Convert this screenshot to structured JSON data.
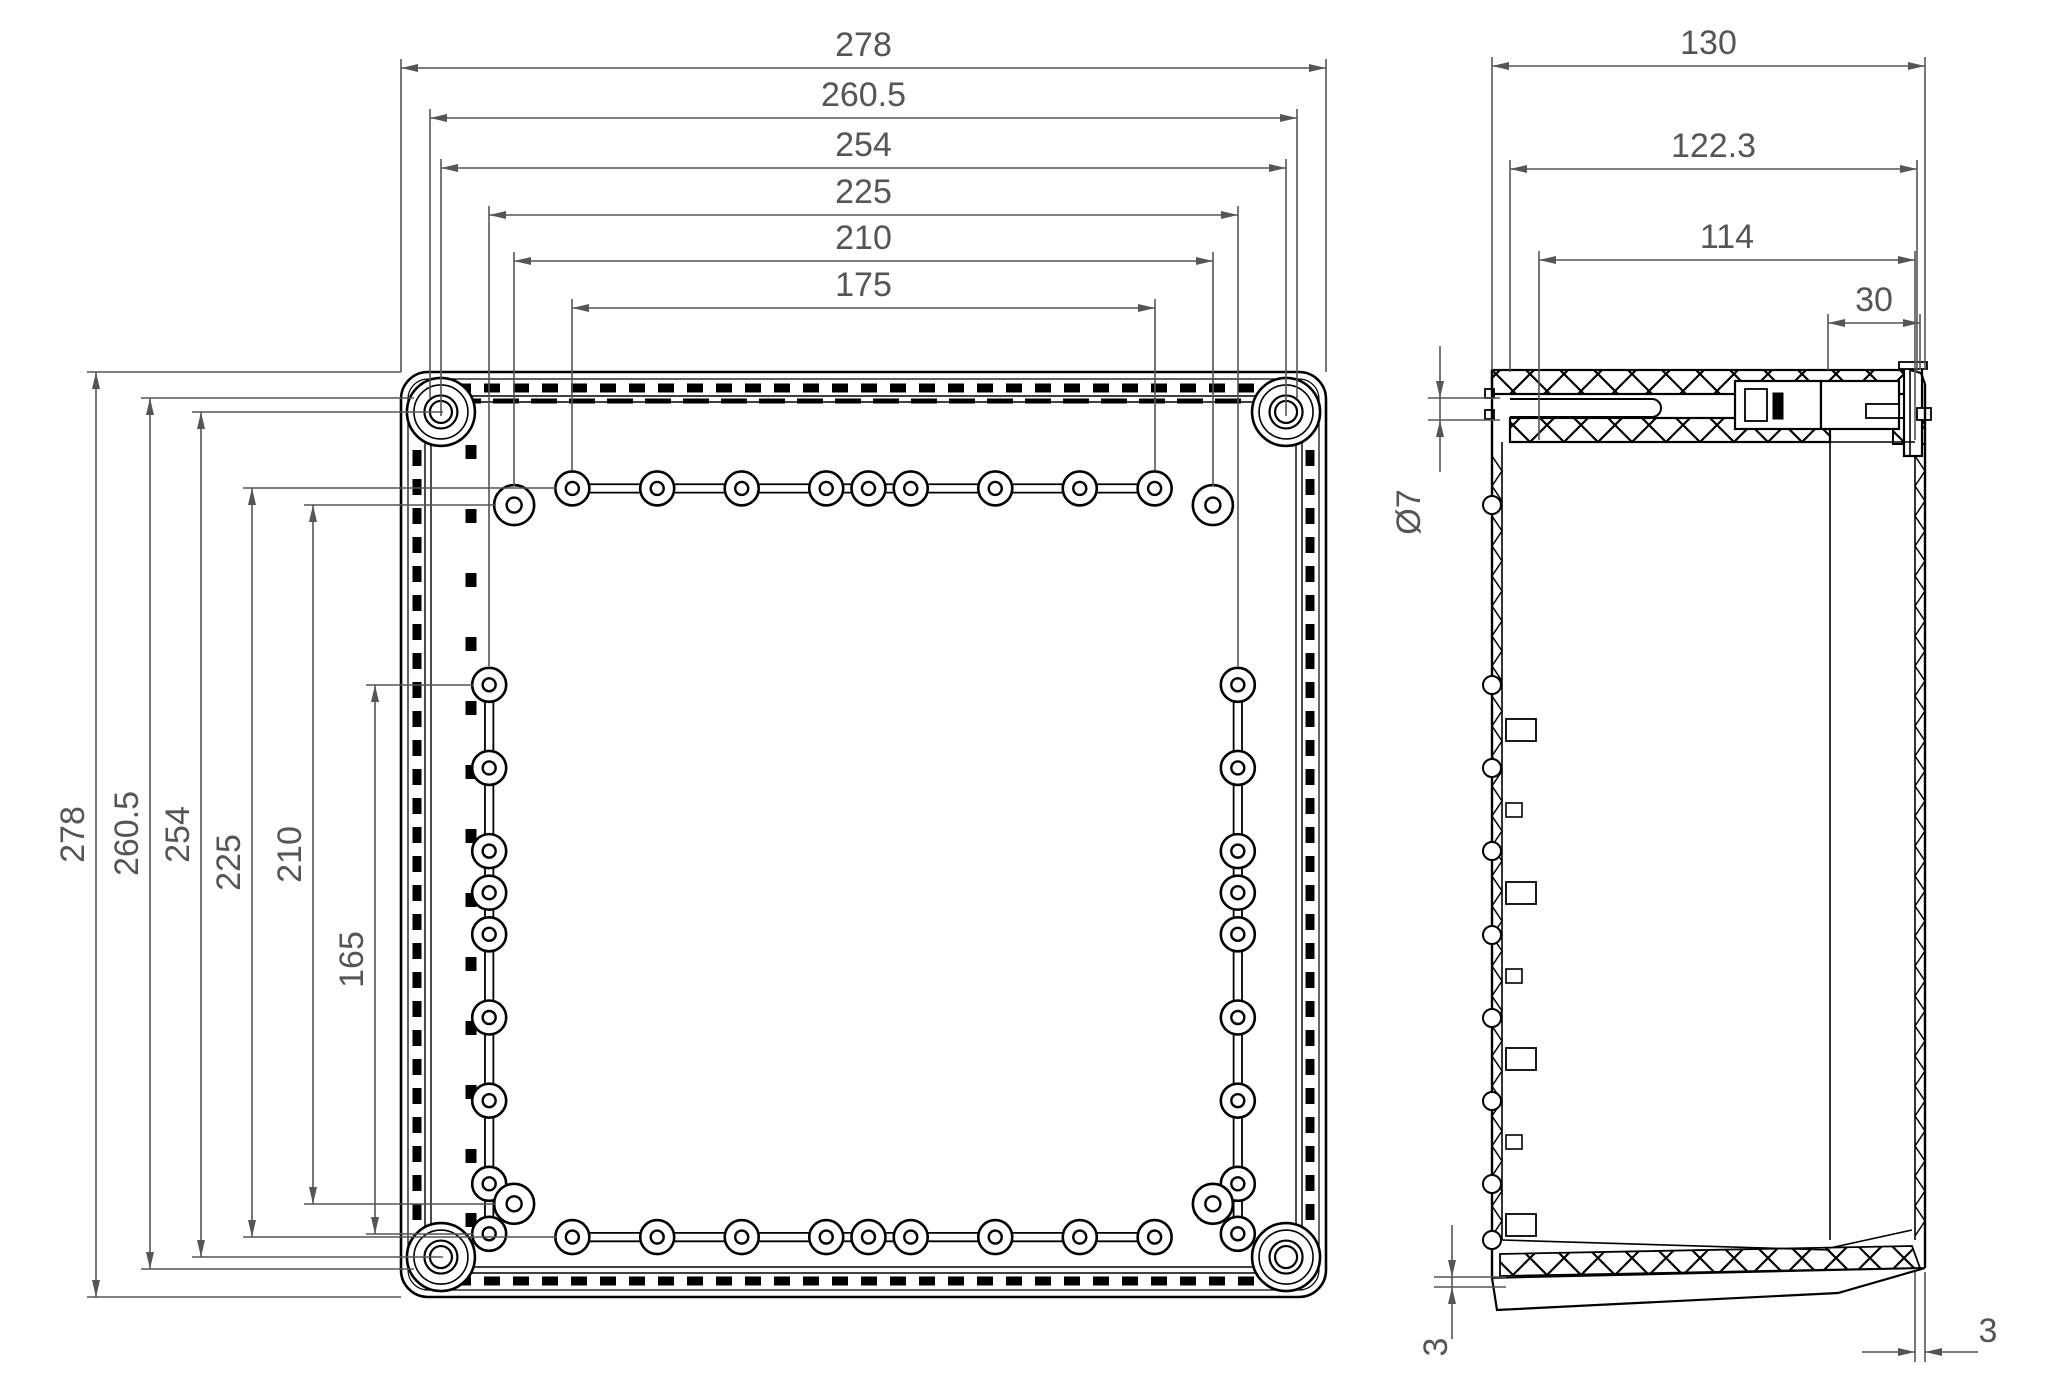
{
  "canvas": {
    "width": 2063,
    "height": 1376,
    "background": "#ffffff"
  },
  "colors": {
    "geometry": "#000000",
    "dimension": "#555555"
  },
  "front_view": {
    "name": "enclosure-front-face",
    "outer_size_mm": 278,
    "scale_px_per_mm": 3.3273,
    "origin_px": {
      "x": 401,
      "y": 372
    },
    "dims_top": [
      {
        "label": "278",
        "y": 68,
        "x1": 401,
        "x2": 1326,
        "ext": 372
      },
      {
        "label": "260.5",
        "y": 118,
        "x1": 430,
        "x2": 1297,
        "ext": 398
      },
      {
        "label": "254",
        "y": 168,
        "x1": 441,
        "x2": 1286,
        "ext": 416
      },
      {
        "label": "225",
        "y": 215,
        "x1": 489,
        "x2": 1238,
        "ext": 666
      },
      {
        "label": "210",
        "y": 261,
        "x1": 514,
        "x2": 1213,
        "ext": 486
      },
      {
        "label": "175",
        "y": 308,
        "x1": 572,
        "x2": 1155,
        "ext": 470
      }
    ],
    "dims_left": [
      {
        "label": "278",
        "x": 96,
        "y1": 372,
        "y2": 1297,
        "ext": 401
      },
      {
        "label": "260.5",
        "x": 150,
        "y1": 398,
        "y2": 1269,
        "ext": 414
      },
      {
        "label": "254",
        "x": 201,
        "y1": 412,
        "y2": 1257,
        "ext": 443
      },
      {
        "label": "225",
        "x": 252,
        "y1": 488,
        "y2": 1237,
        "ext": 556
      },
      {
        "label": "210",
        "x": 313,
        "y1": 505,
        "y2": 1204,
        "ext": 496
      },
      {
        "label": "165",
        "x": 375,
        "y1": 685,
        "y2": 1234,
        "ext": 473
      }
    ],
    "holes_mm": {
      "row_x": [
        51.5,
        77,
        102.4,
        127.8,
        140.5,
        153.2,
        178.6,
        204,
        226.5
      ],
      "row_y_top": 35,
      "row_y_bottom": 260,
      "col_y": [
        94,
        119,
        144,
        156.5,
        169,
        194,
        219,
        244,
        259
      ],
      "col_x_left": 26.5,
      "col_x_right": 251.5,
      "diagonal_x": [
        34,
        244
      ],
      "diagonal_y": [
        40,
        250
      ],
      "corner_boss_inset": 12,
      "corner_boss_spacing": 254
    }
  },
  "side_view": {
    "name": "enclosure-side-section",
    "dims_top": [
      {
        "label": "130",
        "y": 66,
        "x1": 1492,
        "x2": 1925,
        "ext": 370
      },
      {
        "label": "122.3",
        "y": 169,
        "x1": 1510,
        "x2": 1917,
        "ext": 372
      },
      {
        "label": "114",
        "y": 260,
        "x1": 1539,
        "x2": 1915,
        "ext": 440
      },
      {
        "label": "30",
        "y": 323,
        "x1": 1828,
        "x2": 1920,
        "ext": 370
      }
    ],
    "hole_dia_dim": {
      "label": "Ø7",
      "x": 1440,
      "y1": 398,
      "y2": 420,
      "ext_x1": 1428,
      "ext_x2": 1500,
      "text_x": 1420,
      "text_y": 512
    },
    "bottom_thickness_dim": {
      "label": "3",
      "x": 1452,
      "y1": 1277,
      "y2": 1287,
      "ext_x1": 1434,
      "ext_x2": 1506,
      "text_x": 1447,
      "text_y": 1347
    },
    "wall_thickness_dim": {
      "label": "3",
      "y": 1352,
      "x1": 1915,
      "x2": 1925,
      "ext_y1": 1272,
      "ext_y2": 1362,
      "text_x": 1988,
      "text_y": 1342
    },
    "bumps_y": [
      505,
      685,
      768,
      851,
      935,
      1018,
      1101,
      1184,
      1240
    ],
    "pads_big_y": [
      730,
      893,
      1059,
      1225
    ],
    "pads_small_y": [
      810,
      976,
      1142
    ]
  }
}
